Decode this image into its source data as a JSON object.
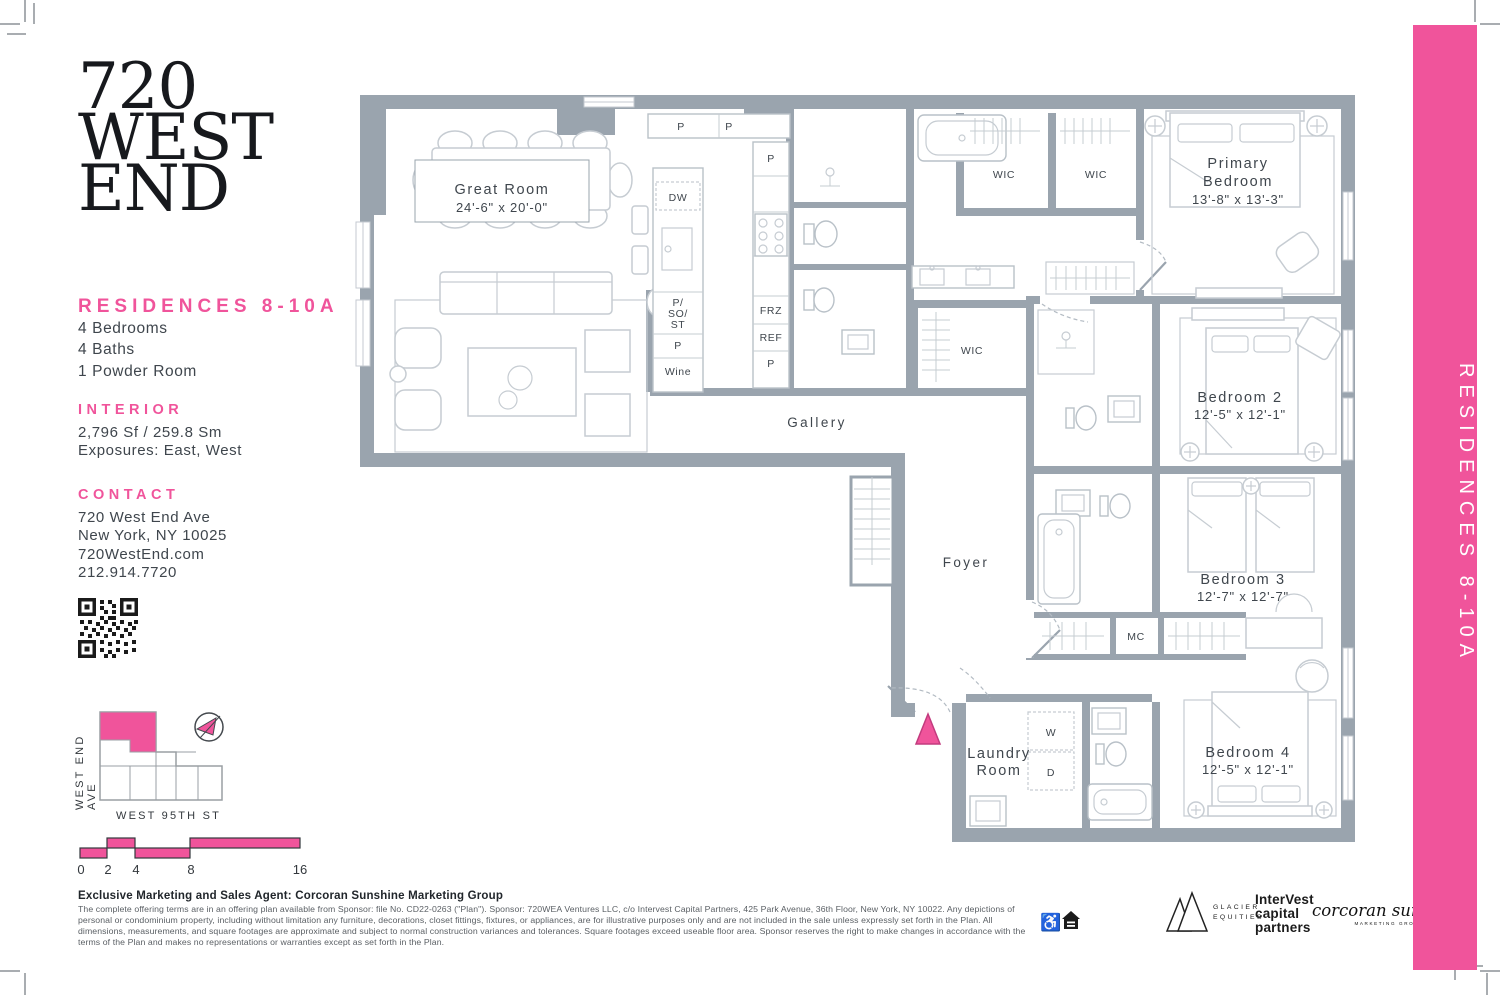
{
  "page": {
    "logo_lines": [
      "720",
      "WEST",
      "END"
    ],
    "residence_title": "RESIDENCES 8-10A",
    "features": [
      "4 Bedrooms",
      "4 Baths",
      "1 Powder Room"
    ],
    "interior": {
      "heading": "INTERIOR",
      "area": "2,796 Sf / 259.8 Sm",
      "exposures": "Exposures: East, West"
    },
    "contact": {
      "heading": "CONTACT",
      "lines": [
        "720 West End Ave",
        "New York, NY 10025",
        "720WestEnd.com",
        "212.914.7720"
      ]
    },
    "sitemap": {
      "street_left": "WEST END AVE",
      "street_bottom": "WEST 95TH ST",
      "scale_ticks": [
        "0",
        "2",
        "4",
        "8",
        "16"
      ]
    },
    "side_banner": "RESIDENCES 8-10A",
    "colors": {
      "accent_pink": "#f0549b",
      "wall_gray": "#9aa4ae"
    }
  },
  "plan": {
    "rooms": [
      {
        "line1": "Great Room",
        "line2": "24'-6\" x 20'-0\""
      },
      {
        "line1": "Primary",
        "line2": "Bedroom",
        "line3": "13'-8\" x 13'-3\""
      },
      {
        "line1": "Bedroom 2",
        "line2": "12'-5\" x 12'-1\""
      },
      {
        "line1": "Bedroom 3",
        "line2": "12'-7\" x 12'-7\""
      },
      {
        "line1": "Bedroom 4",
        "line2": "12'-5\" x 12'-1\""
      }
    ],
    "labels": [
      {
        "t": "P"
      },
      {
        "t": "P"
      },
      {
        "t": "P"
      },
      {
        "t": "DW"
      },
      {
        "t": "P/"
      },
      {
        "t": "SO/"
      },
      {
        "t": "ST"
      },
      {
        "t": "P"
      },
      {
        "t": "Wine"
      },
      {
        "t": "FRZ"
      },
      {
        "t": "REF"
      },
      {
        "t": "P"
      },
      {
        "t": "WIC"
      },
      {
        "t": "WIC"
      },
      {
        "t": "WIC"
      },
      {
        "t": "Gallery"
      },
      {
        "t": "Foyer"
      },
      {
        "t": "MC"
      },
      {
        "t": "W"
      },
      {
        "t": "D"
      },
      {
        "t": "Laundry"
      },
      {
        "t": "Room"
      }
    ]
  },
  "footer": {
    "agent_line": "Exclusive Marketing and Sales Agent: Corcoran Sunshine Marketing Group",
    "disclaimer": "The complete offering terms are in an offering plan available from Sponsor: file No. CD22-0263 (\"Plan\"). Sponsor: 720WEA Ventures LLC, c/o Intervest Capital Partners, 425 Park Avenue, 36th Floor, New York, NY 10022.  Any depictions of personal or condominium property, including without limitation any furniture, decorations, closet fittings, fixtures, or appliances, are for illustrative purposes only and are not included in the sale unless expressly set forth in the Plan.   All dimensions, measurements, and square footages are approximate and subject to normal construction variances and tolerances. Square footages exceed useable floor area.  Sponsor reserves the right to make changes in accordance with the terms of the Plan and makes no representations or warranties except as set forth in the Plan.",
    "logos": {
      "glacier_line1": "GLACIER",
      "glacier_line2": "EQUITIES",
      "intervest_lines": [
        "InterVest",
        "capital",
        "partners"
      ],
      "corcoran": "corcoran sunshine",
      "corcoran_sub": "MARKETING GROUP"
    }
  }
}
